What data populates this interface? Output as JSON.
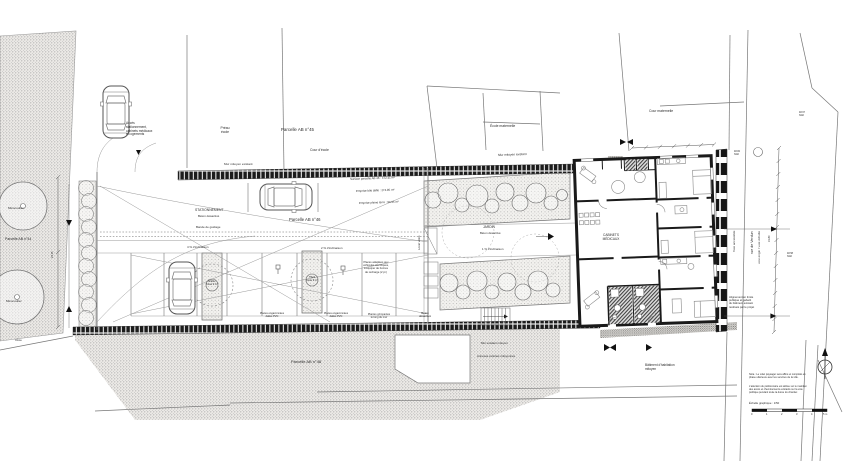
{
  "colors": {
    "paper": "#ffffff",
    "line": "#777777",
    "wall": "#1a1a1a",
    "text": "#333333"
  },
  "scale": {
    "caption": "Échelle graphique : 1/50"
  },
  "labels": [
    {
      "id": "access-note",
      "t": "Accès\nstationnement,\ncabinets médicaux\net logements",
      "x": 126,
      "y": 122,
      "s": 3.2
    },
    {
      "id": "preau-ecole",
      "t": "Préau\nécole",
      "x": 214,
      "y": 126,
      "s": 3.4,
      "w": 22,
      "a": "c"
    },
    {
      "id": "parcelle-45",
      "t": "Parcelle AB n°45",
      "x": 281,
      "y": 127,
      "s": 4.4
    },
    {
      "id": "cour-ecole",
      "t": "Cour d'école",
      "x": 310,
      "y": 148,
      "s": 3.4
    },
    {
      "id": "ecole-maternelle",
      "t": "École maternelle",
      "x": 490,
      "y": 124,
      "s": 3.4
    },
    {
      "id": "cour-maternelle",
      "t": "Cour maternelle",
      "x": 649,
      "y": 109,
      "s": 3.4
    },
    {
      "id": "mur-mitoyen-1",
      "t": "Mur mitoyen existant",
      "x": 224,
      "y": 163,
      "s": 3.1
    },
    {
      "id": "mur-mitoyen-2",
      "t": "Mur mitoyen existant",
      "x": 498,
      "y": 154,
      "s": 3.1,
      "r": -2
    },
    {
      "id": "stationnement",
      "t": "STATIONNEMENT",
      "x": 195,
      "y": 208,
      "s": 3.4
    },
    {
      "id": "beton-desactive-1",
      "t": "Béton désactivé",
      "x": 198,
      "y": 215,
      "s": 3
    },
    {
      "id": "bande-guidage",
      "t": "Bande de guidage",
      "x": 196,
      "y": 226,
      "s": 3
    },
    {
      "id": "parcelle-46",
      "t": "Parcelle AB n°46",
      "x": 289,
      "y": 218,
      "s": 4.2
    },
    {
      "id": "surface-parcelle",
      "t": "Surface parcelle AB 46 : 472.41 m²",
      "x": 350,
      "y": 178,
      "s": 2.9,
      "r": -2
    },
    {
      "id": "emprise-dalle",
      "t": "Emprise bâti dalle : 274.85 m²",
      "x": 356,
      "y": 190,
      "s": 2.9,
      "r": -2
    },
    {
      "id": "emprise-terre",
      "t": "Emprise pleine terre : 90.95 m²",
      "x": 359,
      "y": 202,
      "s": 2.9,
      "r": -2
    },
    {
      "id": "inclinaison-4",
      "t": "4 % d'inclinaison",
      "x": 187,
      "y": 246,
      "s": 2.9
    },
    {
      "id": "inclinaison-2",
      "t": "2 % d'inclinaison",
      "x": 321,
      "y": 247,
      "s": 2.9
    },
    {
      "id": "ev-note",
      "t": "Places adaptées aux\nvéhicules électriques,\nà équiper de bornes\nde recharge (2 pl.)",
      "x": 352,
      "y": 261,
      "s": 2.7,
      "w": 48,
      "a": "c"
    },
    {
      "id": "pvc-1",
      "t": "Places engazonnées\ndalles PVC",
      "x": 256,
      "y": 312,
      "s": 2.6,
      "w": 32,
      "a": "c"
    },
    {
      "id": "pvc-2",
      "t": "Places engazonnées\ndalles PVC",
      "x": 320,
      "y": 312,
      "s": 2.6,
      "w": 32,
      "a": "c"
    },
    {
      "id": "grimpantes",
      "t": "Plantes grimpantes\nle long du mur",
      "x": 362,
      "y": 313,
      "s": 2.6,
      "w": 34,
      "a": "c"
    },
    {
      "id": "micocoulier-1",
      "t": "Micocoulier",
      "x": 8,
      "y": 207,
      "s": 3.1
    },
    {
      "id": "micocoulier-2",
      "t": "Micocoulier",
      "x": 6,
      "y": 300,
      "s": 3.1
    },
    {
      "id": "parcelle-44",
      "t": "Parcelle AB n°44",
      "x": 5,
      "y": 237,
      "s": 3.5
    },
    {
      "id": "oree",
      "t": "Orée",
      "x": 15,
      "y": 339,
      "s": 3.1
    },
    {
      "id": "jardin",
      "t": "JARDIN",
      "x": 483,
      "y": 226,
      "s": 3.3
    },
    {
      "id": "beton-desactive-2",
      "t": "Béton désactivé",
      "x": 480,
      "y": 232,
      "s": 2.9
    },
    {
      "id": "inclinaison-1",
      "t": "1 % d'inclinaison",
      "x": 482,
      "y": 248,
      "s": 2.9
    },
    {
      "id": "beton-desactive-3",
      "t": "Béton\ndésactivé",
      "x": 415,
      "y": 312,
      "s": 2.9,
      "w": 20,
      "a": "c"
    },
    {
      "id": "local-velos",
      "t": "Local vélos",
      "x": 418,
      "y": 250,
      "s": 2.9,
      "r": -90
    },
    {
      "id": "cabinets-medicaux",
      "t": "CABINETS\nMÉDICAUX",
      "x": 599,
      "y": 234,
      "s": 3.2,
      "w": 24,
      "a": "c"
    },
    {
      "id": "rue-de-verdun",
      "t": "rue de Verdun",
      "x": 750,
      "y": 254,
      "s": 3.6,
      "r": -90
    },
    {
      "id": "voie-engin",
      "t": "voie engin / voie échelle",
      "x": 758,
      "y": 264,
      "s": 3.1,
      "r": -90
    },
    {
      "id": "voie-accessible",
      "t": "Voie accessible",
      "x": 733,
      "y": 252,
      "s": 3.1,
      "r": -90
    },
    {
      "id": "alignement-note",
      "t": "Alignement en limite\npublique et gabarit\ndu bâtiment existant\nrestitués par le projet",
      "x": 729,
      "y": 296,
      "s": 2.7,
      "w": 36
    },
    {
      "id": "batiment-habitation",
      "t": "Bâtiment d'habitation\nmitoyen",
      "x": 645,
      "y": 364,
      "s": 3.2,
      "w": 42
    },
    {
      "id": "mur-existant-mitoyen",
      "t": "Mur existant mitoyen",
      "x": 481,
      "y": 342,
      "s": 2.9
    },
    {
      "id": "annexes-voisines",
      "t": "Annexes voisines mitoyennes",
      "x": 477,
      "y": 355,
      "s": 2.9
    },
    {
      "id": "parcelle-48",
      "t": "Parcelle AB n°48",
      "x": 291,
      "y": 360,
      "s": 4
    },
    {
      "id": "nota-1",
      "t": "Nota : Le volet paysager sera affiné et complété en\nphase ultérieure avec les services de la ville.",
      "x": 749,
      "y": 374,
      "s": 2.5,
      "w": 62
    },
    {
      "id": "nota-2",
      "t": "L'attention du pétitionnaire est attirée sur le maintien\ndes accès et cheminements existants sur la voie\npublique pendant toute la durée du chantier.",
      "x": 749,
      "y": 386,
      "s": 2.5,
      "w": 62
    },
    {
      "id": "echelle-graphique",
      "t": "Échelle graphique : 1/50",
      "x": 749,
      "y": 402,
      "s": 2.8
    },
    {
      "id": "niveau-1",
      "t": "48.82\nNGF",
      "x": 734,
      "y": 151,
      "s": 2.4
    },
    {
      "id": "niveau-2",
      "t": "48.67\nNGF",
      "x": 799,
      "y": 112,
      "s": 2.4
    },
    {
      "id": "niveau-3",
      "t": "48.58\nNGF",
      "x": 787,
      "y": 253,
      "s": 2.4
    },
    {
      "id": "dim-droite",
      "t": "31.80",
      "x": 768,
      "y": 242,
      "s": 2.6,
      "r": -90
    },
    {
      "id": "dim-gauche",
      "t": "24.15",
      "x": 51,
      "y": 258,
      "s": 2.6,
      "r": -90
    },
    {
      "id": "ilot-1",
      "t": "Érable\nfosse 9 m³",
      "x": 203,
      "y": 281,
      "s": 2.4,
      "w": 18,
      "a": "c"
    },
    {
      "id": "ilot-2",
      "t": "Tilleul\nfosse 9 m³",
      "x": 303,
      "y": 277,
      "s": 2.4,
      "w": 18,
      "a": "c"
    },
    {
      "id": "scale-0",
      "t": "0",
      "x": 751,
      "y": 413,
      "s": 2.6
    },
    {
      "id": "scale-1",
      "t": "1",
      "x": 766,
      "y": 413,
      "s": 2.6
    },
    {
      "id": "scale-2",
      "t": "2",
      "x": 781,
      "y": 413,
      "s": 2.6
    },
    {
      "id": "scale-3",
      "t": "3",
      "x": 796,
      "y": 413,
      "s": 2.6
    },
    {
      "id": "scale-4",
      "t": "4",
      "x": 811,
      "y": 413,
      "s": 2.6
    },
    {
      "id": "scale-5",
      "t": "5 m",
      "x": 823,
      "y": 413,
      "s": 2.6
    }
  ]
}
